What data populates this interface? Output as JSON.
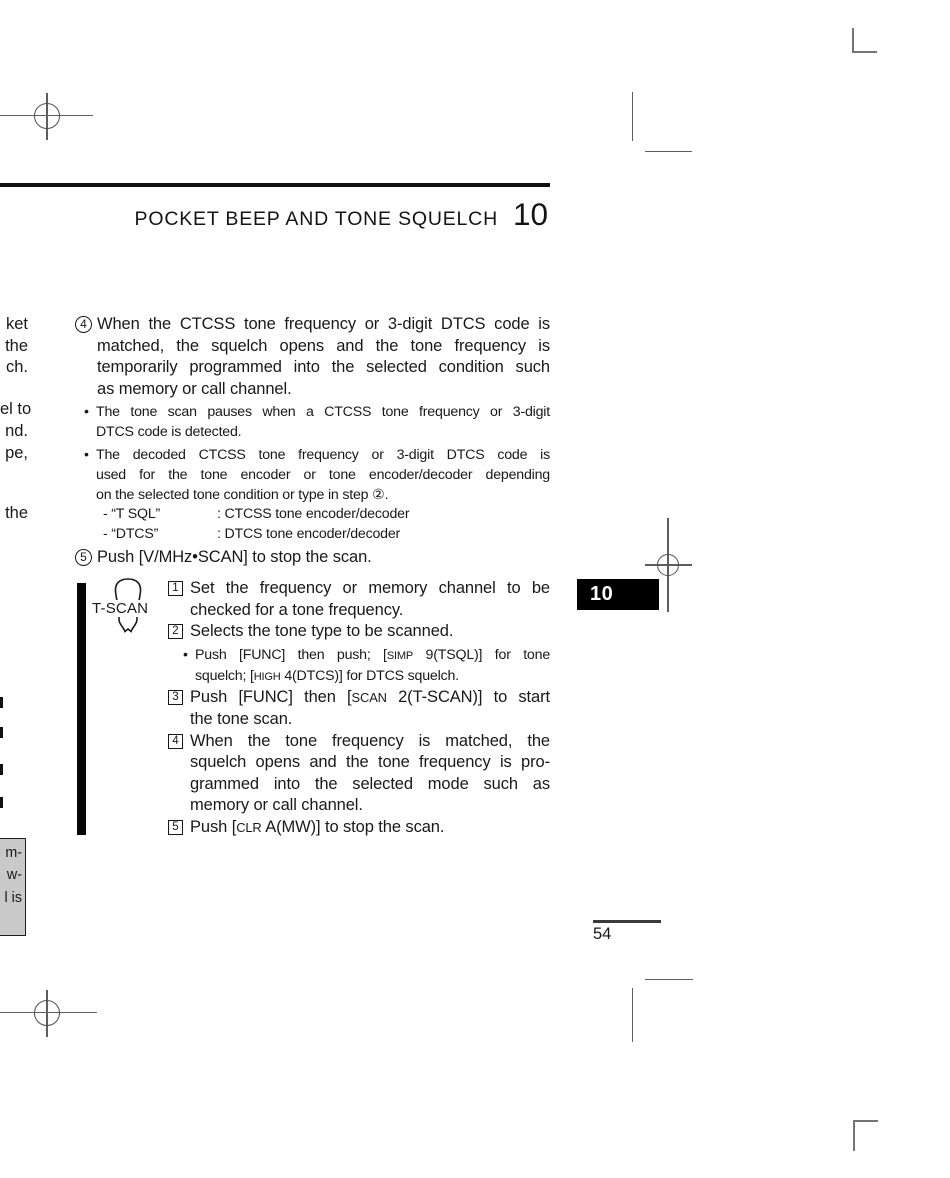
{
  "header": {
    "title": "POCKET BEEP AND TONE SQUELCH",
    "chapter": "10"
  },
  "chapter_tab": "10",
  "page_number": "54",
  "bullet_char": "•",
  "left_margin_fragments": {
    "f1": "ket",
    "f2": "the",
    "f3": "ch.",
    "f4": "el to",
    "f5": "nd.",
    "f6": "pe,",
    "f7": "the"
  },
  "note_box": {
    "l1": "m-",
    "l2": "w-",
    "l3": "l is"
  },
  "steps": {
    "s4": {
      "marker": "4",
      "l1": "When the CTCSS tone frequency or 3-digit DTCS code is",
      "l2": "matched, the squelch opens and the tone frequency is",
      "l3": "temporarily programmed into the selected condition such",
      "l4": "as memory or call channel."
    },
    "s4_note1": {
      "l1": "The tone scan pauses when a CTCSS tone frequency or 3-digit",
      "l2": "DTCS code is detected."
    },
    "s4_note2": {
      "l1": "The decoded CTCSS tone frequency or 3-digit DTCS code is",
      "l2": "used for the tone encoder or tone encoder/decoder depending",
      "l3": "on the selected tone condition or type in step ②."
    },
    "tsql_def": {
      "label": "- “T SQL”",
      "desc": ": CTCSS tone encoder/decoder"
    },
    "dtcs_def": {
      "label": "- “DTCS”",
      "desc": ": DTCS tone encoder/decoder"
    },
    "s5": {
      "marker": "5",
      "l1": "Push [V/MHz•SCAN] to stop the scan."
    }
  },
  "tscan_box": {
    "key_label": "T-SCAN",
    "i1": {
      "marker": "1",
      "l1": "Set the frequency or memory channel to be",
      "l2": "checked for a tone frequency."
    },
    "i2": {
      "marker": "2",
      "l1": "Selects the tone type to be scanned."
    },
    "i2_note": {
      "seg1": "Push [FUNC] then push; [",
      "sc1": "SIMP",
      "seg2": " 9(TSQL)] for tone",
      "seg3": "squelch; [",
      "sc2": "HIGH",
      "seg4": " 4(DTCS)] for DTCS squelch."
    },
    "i3": {
      "marker": "3",
      "seg1": "Push [FUNC] then [",
      "sc1": "SCAN",
      "seg2": " 2(T-SCAN)] to start",
      "l2": "the tone scan."
    },
    "i4": {
      "marker": "4",
      "l1": "When the tone frequency is matched, the",
      "l2": "squelch opens and the tone frequency is pro-",
      "l3": "grammed into the selected mode such as",
      "l4": "memory or call channel."
    },
    "i5": {
      "marker": "5",
      "seg1": "Push [",
      "sc1": "CLR",
      "seg2": " A(MW)] to stop the scan."
    }
  }
}
